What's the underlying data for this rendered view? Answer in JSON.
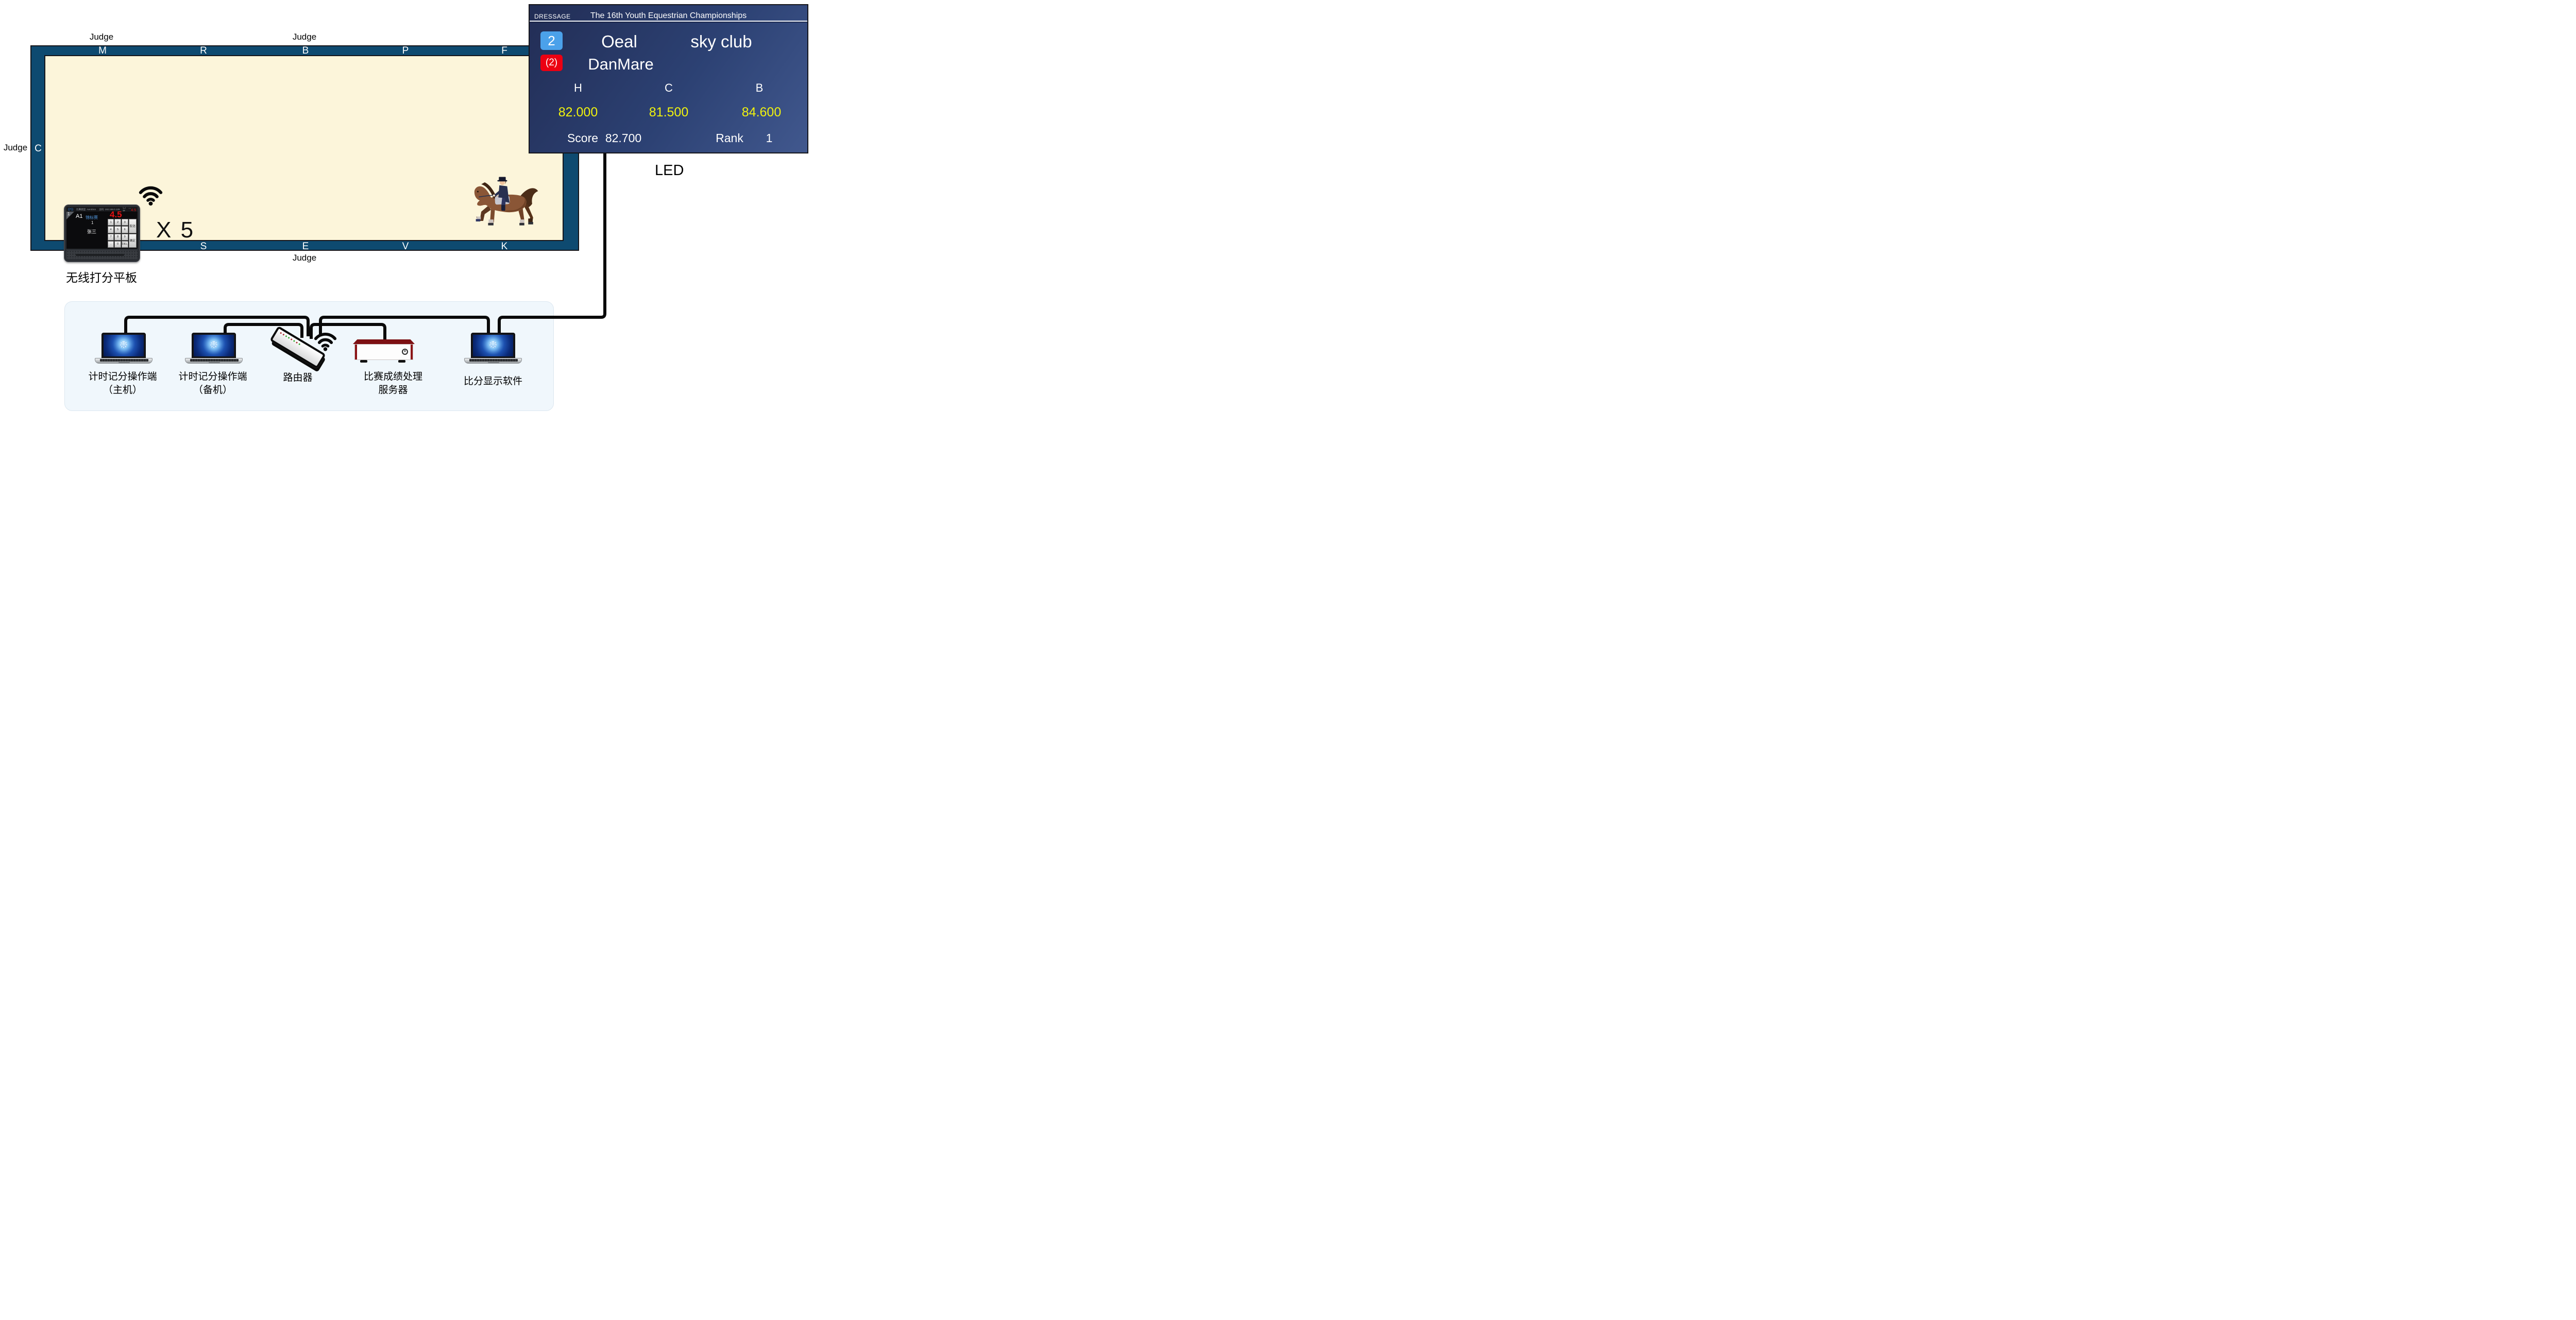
{
  "arena": {
    "judge_label": "Judge",
    "letters_top": [
      "M",
      "R",
      "B",
      "P",
      "F"
    ],
    "letters_bottom": [
      "S",
      "E",
      "V",
      "K"
    ],
    "letter_left": "C",
    "colors": {
      "rail": "#0e4a70",
      "field": "#fcf5da"
    }
  },
  "courtside": {
    "multiplier": "X 5",
    "tablet_caption": "无线打分平板"
  },
  "tablet": {
    "statusbar_left": "比赛类型: Aerobics",
    "statusbar_right": "主机: 192.168.0.129",
    "statusbar_icons": "▢ … ✂",
    "slot": "1",
    "position": "A1",
    "event": "锦标赛",
    "round": "1",
    "athlete": "张三",
    "score_current": "4.5",
    "score_last": "4.5",
    "key_cancel": "取消",
    "key_confirm": "确定",
    "keys": [
      "1",
      "2",
      "3",
      "4",
      "5",
      "6",
      "7",
      "8",
      "9",
      ".",
      "0",
      "DEL"
    ]
  },
  "scoreboard": {
    "mode": "DRESSAGE",
    "title": "The 16th Youth Equestrian Championships",
    "entry_no": "2",
    "rider": "Oeal",
    "club": "sky club",
    "horse_no": "(2)",
    "horse": "DanMare",
    "judge_positions": [
      "H",
      "C",
      "B"
    ],
    "judge_scores": [
      "82.000",
      "81.500",
      "84.600"
    ],
    "score_label": "Score",
    "total_score": "82.700",
    "rank_label": "Rank",
    "rank": "1",
    "caption": "LED",
    "colors": {
      "bg_start": "#222d55",
      "bg_end": "#41588e",
      "badge_blue": "#4ba1ea",
      "badge_red": "#ec0012",
      "score_yellow": "#f0f20e"
    }
  },
  "network": {
    "laptop_primary_label1": "计时记分操作端",
    "laptop_primary_label2": "（主机）",
    "laptop_backup_label1": "计时记分操作端",
    "laptop_backup_label2": "（备机）",
    "router_label": "路由器",
    "server_label1": "比赛成绩处理",
    "server_label2": "服务器",
    "display_label": "比分显示软件"
  }
}
